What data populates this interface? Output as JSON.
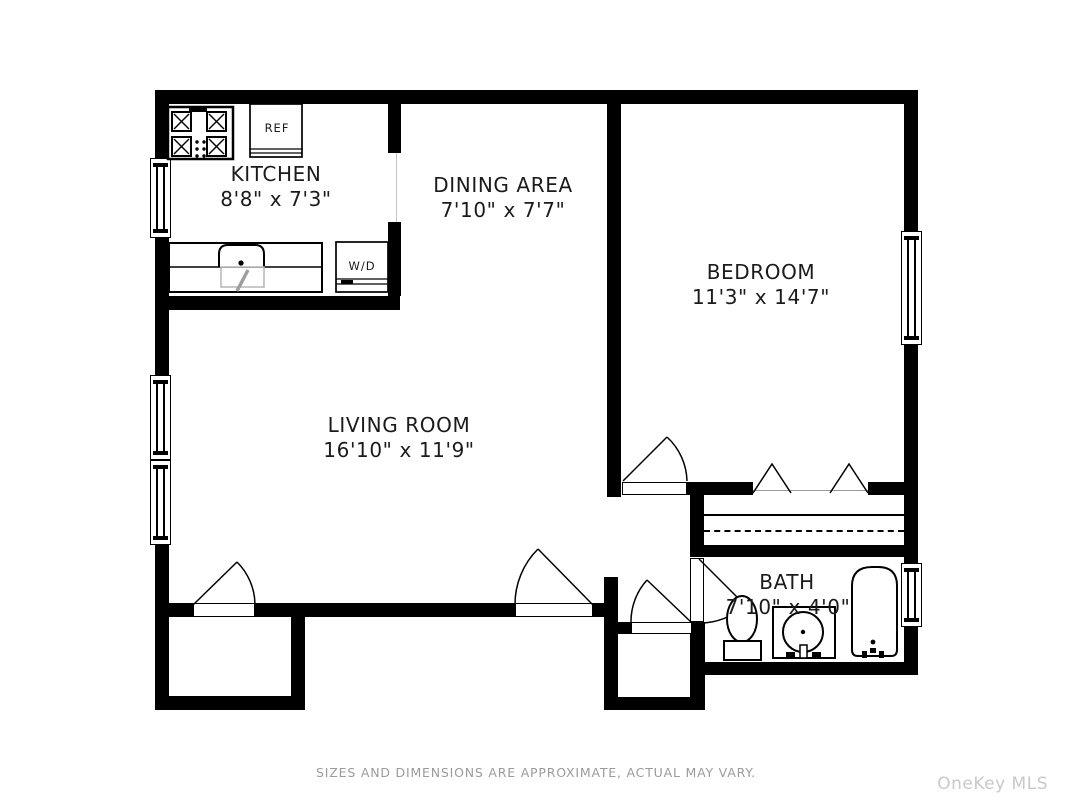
{
  "rooms": {
    "kitchen": {
      "name": "KITCHEN",
      "dims": "8'8\" x 7'3\""
    },
    "dining": {
      "name": "DINING AREA",
      "dims": "7'10\" x 7'7\""
    },
    "bedroom": {
      "name": "BEDROOM",
      "dims": "11'3\" x 14'7\""
    },
    "living": {
      "name": "LIVING ROOM",
      "dims": "16'10\" x 11'9\""
    },
    "bath": {
      "name": "BATH",
      "dims": "7'10\" x 4'0\""
    }
  },
  "fixtures": {
    "refrigerator_label": "REF",
    "washer_dryer_label": "W/D"
  },
  "footer": {
    "disclaimer": "SIZES AND DIMENSIONS ARE APPROXIMATE, ACTUAL MAY VARY."
  },
  "watermark": {
    "text": "OneKey MLS"
  },
  "colors": {
    "wall": "#000000",
    "background": "#ffffff",
    "disclaimer_text": "#9b9b9b",
    "watermark_text": "#c9c9c9",
    "fixture_gray": "#aaaaaa"
  }
}
